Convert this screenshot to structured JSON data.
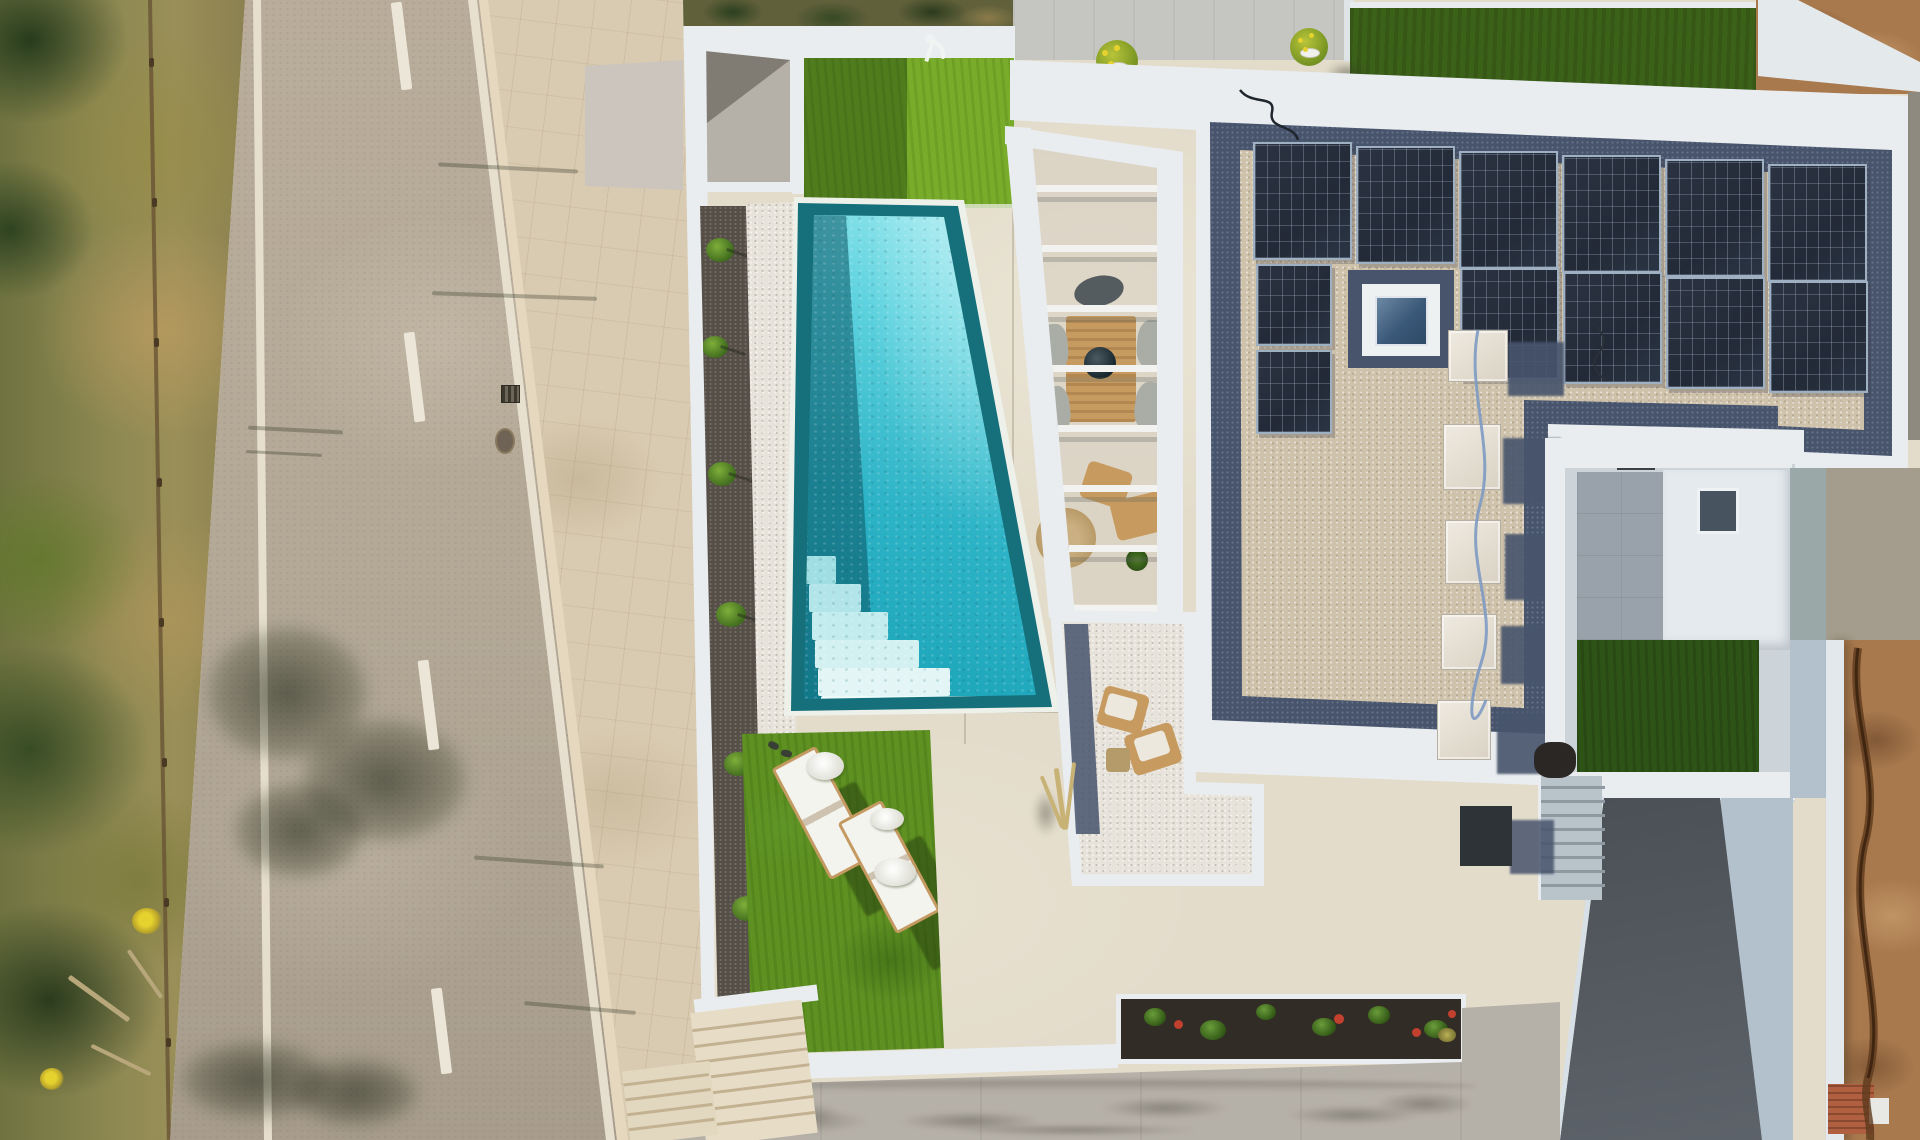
{
  "meta": {
    "description": "Top-down aerial drone photograph of a modern white villa with turquoise pool, solar-panel gravel roof, sun loungers on artificial lawn, pergola with outdoor furniture, street with scrub verge on the left and concrete driveway below."
  },
  "colors": {
    "wall": "#e9edf0",
    "terrace": "#e3dccb",
    "sidewalk": "#d9cbb1",
    "road": "#b3a896",
    "scrub": "#8d8852",
    "pool-border": "#16707c",
    "pool-water": "#2db3c6",
    "pool-water-light": "#a7ecf1",
    "pebble": "#e7e3da",
    "gravel": "#564f48",
    "grass": "#5f9122",
    "grass-dark": "#2e5316",
    "roof-gravel": "#cfc2ab",
    "roof-navy": "#47546c",
    "solar": "#232a37",
    "courtyard": "#99a2aa",
    "ramp": "#4a4f55",
    "apron": "#b3c1cd",
    "dirt": "#a9794e",
    "soil": "#322c26",
    "driveway": "#b6b1a8",
    "wood": "#c79b5f"
  },
  "counts": {
    "solar_panels": 12,
    "pergola_slats": 8,
    "sun_loungers": 2,
    "ac_units": 5,
    "pool_steps": 6,
    "road_dashes": 4,
    "potted_plants": 2
  },
  "sprites": {
    "street-sprites": [
      {
        "c": "dash",
        "n": "road-center-dash",
        "x": 396,
        "y": 2,
        "w": 11,
        "h": 88,
        "r": -7
      },
      {
        "c": "dash",
        "n": "road-center-dash",
        "x": 409,
        "y": 332,
        "w": 11,
        "h": 90,
        "r": -7
      },
      {
        "c": "dash",
        "n": "road-center-dash",
        "x": 423,
        "y": 660,
        "w": 11,
        "h": 90,
        "r": -7
      },
      {
        "c": "dash",
        "n": "road-center-dash",
        "x": 436,
        "y": 988,
        "w": 11,
        "h": 86,
        "r": -7
      },
      {
        "c": "streak",
        "n": "post-shadow",
        "x": 248,
        "y": 428,
        "w": 95,
        "h": 4,
        "r": 3
      },
      {
        "c": "streak",
        "n": "post-shadow",
        "x": 246,
        "y": 452,
        "w": 76,
        "h": 3,
        "r": 3
      },
      {
        "c": "streak",
        "n": "post-shadow",
        "x": 438,
        "y": 166,
        "w": 140,
        "h": 4,
        "r": 3
      },
      {
        "c": "streak",
        "n": "post-shadow",
        "x": 432,
        "y": 294,
        "w": 165,
        "h": 4,
        "r": 2
      },
      {
        "c": "streak",
        "n": "post-shadow",
        "x": 474,
        "y": 860,
        "w": 130,
        "h": 4,
        "r": 4
      },
      {
        "c": "streak",
        "n": "post-shadow",
        "x": 524,
        "y": 1006,
        "w": 112,
        "h": 4,
        "r": 5
      },
      {
        "c": "post",
        "n": "fence-post",
        "x": 149,
        "y": 58,
        "w": 5,
        "h": 9
      },
      {
        "c": "post",
        "n": "fence-post",
        "x": 152,
        "y": 198,
        "w": 5,
        "h": 9
      },
      {
        "c": "post",
        "n": "fence-post",
        "x": 154,
        "y": 338,
        "w": 5,
        "h": 9
      },
      {
        "c": "post",
        "n": "fence-post",
        "x": 157,
        "y": 478,
        "w": 5,
        "h": 9
      },
      {
        "c": "post",
        "n": "fence-post",
        "x": 159,
        "y": 618,
        "w": 5,
        "h": 9
      },
      {
        "c": "post",
        "n": "fence-post",
        "x": 162,
        "y": 758,
        "w": 5,
        "h": 9
      },
      {
        "c": "post",
        "n": "fence-post",
        "x": 164,
        "y": 898,
        "w": 5,
        "h": 9
      },
      {
        "c": "post",
        "n": "fence-post",
        "x": 166,
        "y": 1038,
        "w": 5,
        "h": 9
      },
      {
        "c": "log",
        "n": "fallen-log",
        "x": 62,
        "y": 996,
        "w": 74,
        "h": 5,
        "r": 36
      },
      {
        "c": "log",
        "n": "fallen-log",
        "x": 88,
        "y": 1058,
        "w": 66,
        "h": 4,
        "r": 26
      },
      {
        "c": "log",
        "n": "fallen-log",
        "x": 116,
        "y": 972,
        "w": 58,
        "h": 4,
        "r": 55
      },
      {
        "c": "flower",
        "n": "yellow-flower-bush",
        "x": 132,
        "y": 908,
        "w": 30,
        "h": 26
      },
      {
        "c": "flower",
        "n": "yellow-flower-bush",
        "x": 40,
        "y": 1068,
        "w": 24,
        "h": 22
      }
    ],
    "gravel-shrubs": [
      {
        "c": "shrub",
        "x": 8,
        "y": 32,
        "w": 28,
        "h": 24
      },
      {
        "c": "shrub",
        "x": 4,
        "y": 130,
        "w": 26,
        "h": 22
      },
      {
        "c": "shrub",
        "x": 10,
        "y": 256,
        "w": 28,
        "h": 24
      },
      {
        "c": "shrub",
        "x": 18,
        "y": 396,
        "w": 30,
        "h": 25
      },
      {
        "c": "shrub",
        "x": 26,
        "y": 546,
        "w": 28,
        "h": 24
      },
      {
        "c": "shrub",
        "x": 34,
        "y": 690,
        "w": 30,
        "h": 25
      }
    ],
    "pool-steps": [
      {
        "c": "pstep",
        "n": "pool-step",
        "x": 22,
        "y": 359,
        "w": 30,
        "h": 28,
        "bg": "#9fdfe3"
      },
      {
        "c": "pstep",
        "n": "pool-step",
        "x": 25,
        "y": 387,
        "w": 52,
        "h": 28,
        "bg": "#b2e5e9"
      },
      {
        "c": "pstep",
        "n": "pool-step",
        "x": 28,
        "y": 415,
        "w": 76,
        "h": 28,
        "bg": "#c3ecee"
      },
      {
        "c": "pstep",
        "n": "pool-step",
        "x": 31,
        "y": 443,
        "w": 104,
        "h": 28,
        "bg": "#d4f1f1"
      },
      {
        "c": "pstep",
        "n": "pool-step",
        "x": 34,
        "y": 471,
        "w": 132,
        "h": 28,
        "bg": "#e3f6f5"
      },
      {
        "c": "pstep",
        "n": "pool-step",
        "x": 37,
        "y": 499,
        "w": 160,
        "h": 28,
        "bg": "#ecfaf8"
      }
    ],
    "pergola-slats": [
      {
        "c": "slat",
        "x": 31,
        "y": 59,
        "w": 122,
        "h": 7
      },
      {
        "c": "slat",
        "x": 37,
        "y": 119,
        "w": 117,
        "h": 7
      },
      {
        "c": "slat",
        "x": 42,
        "y": 179,
        "w": 112,
        "h": 7
      },
      {
        "c": "slat",
        "x": 47,
        "y": 239,
        "w": 107,
        "h": 7
      },
      {
        "c": "slat",
        "x": 53,
        "y": 299,
        "w": 101,
        "h": 7
      },
      {
        "c": "slat",
        "x": 58,
        "y": 359,
        "w": 96,
        "h": 7
      },
      {
        "c": "slat",
        "x": 64,
        "y": 419,
        "w": 90,
        "h": 7
      },
      {
        "c": "slat",
        "x": 69,
        "y": 479,
        "w": 85,
        "h": 7
      }
    ],
    "pergola-furniture": [
      {
        "c": "wood",
        "n": "dining-table",
        "x": 61,
        "y": 190,
        "w": 70,
        "h": 106
      },
      {
        "c": "bowl",
        "n": "table-bowl",
        "x": 79,
        "y": 221,
        "w": 32,
        "h": 32
      },
      {
        "c": "chairgray",
        "n": "chair",
        "x": 36,
        "y": 198,
        "w": 27,
        "h": 46,
        "r": -4
      },
      {
        "c": "chairgray",
        "n": "chair",
        "x": 132,
        "y": 194,
        "w": 31,
        "h": 48,
        "r": 5
      },
      {
        "c": "chairgray",
        "n": "chair",
        "x": 38,
        "y": 260,
        "w": 27,
        "h": 46,
        "r": -6
      },
      {
        "c": "chairgray",
        "n": "chair",
        "x": 130,
        "y": 256,
        "w": 31,
        "h": 48,
        "r": 7
      },
      {
        "c": "darkarc",
        "n": "rattan-chair",
        "x": 69,
        "y": 150,
        "w": 50,
        "h": 30,
        "r": -12
      },
      {
        "c": "woodchair",
        "n": "wood-armchair",
        "x": 78,
        "y": 340,
        "w": 46,
        "h": 38,
        "r": 18
      },
      {
        "c": "woodchair",
        "n": "wood-armchair",
        "x": 108,
        "y": 370,
        "w": 52,
        "h": 40,
        "r": -14
      },
      {
        "c": "mat",
        "n": "round-jute-mat",
        "x": 31,
        "y": 382,
        "w": 60,
        "h": 60
      },
      {
        "c": "plantpot",
        "n": "potted-plant",
        "x": 121,
        "y": 423,
        "w": 22,
        "h": 22
      }
    ],
    "court-items": [
      {
        "c": "woodchair",
        "n": "lounge-chair",
        "x": 52,
        "y": 82,
        "w": 46,
        "h": 40,
        "r": 15
      },
      {
        "c": "woodchair",
        "n": "lounge-chair",
        "x": 80,
        "y": 120,
        "w": 50,
        "h": 42,
        "r": -18
      },
      {
        "c": "cushion",
        "n": "cushion",
        "x": 58,
        "y": 88,
        "w": 30,
        "h": 22,
        "r": 15
      },
      {
        "c": "cushion",
        "n": "cushion",
        "x": 88,
        "y": 126,
        "w": 32,
        "h": 24,
        "r": -18
      },
      {
        "c": "ctable",
        "n": "side-table",
        "x": 58,
        "y": 140,
        "w": 24,
        "h": 24
      }
    ],
    "roof-panels": [
      {
        "c": "panel",
        "n": "solar-panel",
        "x": 243,
        "y": 82,
        "w": 99,
        "h": 118
      },
      {
        "c": "panel",
        "n": "solar-panel",
        "x": 346,
        "y": 86,
        "w": 99,
        "h": 118
      },
      {
        "c": "panel",
        "n": "solar-panel",
        "x": 449,
        "y": 91,
        "w": 99,
        "h": 118
      },
      {
        "c": "panel",
        "n": "solar-panel",
        "x": 552,
        "y": 95,
        "w": 99,
        "h": 118
      },
      {
        "c": "panel",
        "n": "solar-panel",
        "x": 655,
        "y": 99,
        "w": 99,
        "h": 118
      },
      {
        "c": "panel",
        "n": "solar-panel",
        "x": 758,
        "y": 104,
        "w": 99,
        "h": 118
      },
      {
        "c": "panel",
        "n": "solar-panel",
        "x": 450,
        "y": 208,
        "w": 99,
        "h": 112
      },
      {
        "c": "panel",
        "n": "solar-panel",
        "x": 553,
        "y": 212,
        "w": 99,
        "h": 112
      },
      {
        "c": "panel",
        "n": "solar-panel",
        "x": 656,
        "y": 217,
        "w": 99,
        "h": 112
      },
      {
        "c": "panel",
        "n": "solar-panel",
        "x": 759,
        "y": 221,
        "w": 99,
        "h": 112
      },
      {
        "c": "panel",
        "n": "solar-panel",
        "x": 246,
        "y": 204,
        "w": 76,
        "h": 82
      },
      {
        "c": "panel",
        "n": "solar-panel",
        "x": 246,
        "y": 290,
        "w": 76,
        "h": 84
      }
    ],
    "roof-ac": [
      {
        "c": "acshadow",
        "n": "ac-shadow",
        "x": 498,
        "y": 282,
        "w": 56,
        "h": 54
      },
      {
        "c": "acshadow",
        "n": "ac-shadow",
        "x": 493,
        "y": 378,
        "w": 58,
        "h": 66
      },
      {
        "c": "acshadow",
        "n": "ac-shadow",
        "x": 495,
        "y": 474,
        "w": 56,
        "h": 66
      },
      {
        "c": "acshadow",
        "n": "ac-shadow",
        "x": 491,
        "y": 566,
        "w": 56,
        "h": 58
      },
      {
        "c": "acshadow",
        "n": "ac-shadow",
        "x": 487,
        "y": 652,
        "w": 54,
        "h": 62
      },
      {
        "c": "acunit",
        "n": "ac-unit",
        "x": 438,
        "y": 270,
        "w": 60,
        "h": 52
      },
      {
        "c": "acunit",
        "n": "ac-unit",
        "x": 433,
        "y": 364,
        "w": 58,
        "h": 66
      },
      {
        "c": "acunit",
        "n": "ac-unit",
        "x": 435,
        "y": 460,
        "w": 56,
        "h": 64
      },
      {
        "c": "acunit",
        "n": "ac-unit",
        "x": 431,
        "y": 554,
        "w": 56,
        "h": 56
      },
      {
        "c": "acunit",
        "n": "ac-unit",
        "x": 427,
        "y": 640,
        "w": 54,
        "h": 60
      }
    ],
    "cstairs-treads": [
      {
        "c": "tread",
        "x": 0,
        "y": 10,
        "w": 64,
        "h": 3
      },
      {
        "c": "tread",
        "x": 0,
        "y": 24,
        "w": 64,
        "h": 3
      },
      {
        "c": "tread",
        "x": 0,
        "y": 38,
        "w": 64,
        "h": 3
      },
      {
        "c": "tread",
        "x": 0,
        "y": 52,
        "w": 64,
        "h": 3
      },
      {
        "c": "tread",
        "x": 0,
        "y": 66,
        "w": 64,
        "h": 3
      },
      {
        "c": "tread",
        "x": 0,
        "y": 80,
        "w": 64,
        "h": 3
      },
      {
        "c": "tread",
        "x": 0,
        "y": 94,
        "w": 64,
        "h": 3
      },
      {
        "c": "tread",
        "x": 0,
        "y": 108,
        "w": 64,
        "h": 3
      }
    ],
    "sw1-treads": [
      {
        "c": "tread2",
        "x": 0,
        "y": 16,
        "w": 112,
        "h": 3
      },
      {
        "c": "tread2",
        "x": 0,
        "y": 32,
        "w": 112,
        "h": 3
      },
      {
        "c": "tread2",
        "x": 0,
        "y": 48,
        "w": 112,
        "h": 3
      },
      {
        "c": "tread2",
        "x": 0,
        "y": 64,
        "w": 112,
        "h": 3
      },
      {
        "c": "tread2",
        "x": 0,
        "y": 80,
        "w": 112,
        "h": 3
      },
      {
        "c": "tread2",
        "x": 0,
        "y": 96,
        "w": 112,
        "h": 3
      },
      {
        "c": "tread2",
        "x": 0,
        "y": 112,
        "w": 112,
        "h": 3
      }
    ],
    "sw2-treads": [
      {
        "c": "tread2",
        "x": 0,
        "y": 12,
        "w": 86,
        "h": 3
      },
      {
        "c": "tread2",
        "x": 0,
        "y": 27,
        "w": 86,
        "h": 3
      },
      {
        "c": "tread2",
        "x": 0,
        "y": 42,
        "w": 86,
        "h": 3
      },
      {
        "c": "tread2",
        "x": 0,
        "y": 57,
        "w": 86,
        "h": 3
      }
    ],
    "planter-plants": [
      {
        "c": "pgreen",
        "n": "planter-shrub",
        "x": 28,
        "y": 14,
        "w": 22,
        "h": 18
      },
      {
        "c": "pgreen",
        "n": "planter-shrub",
        "x": 84,
        "y": 26,
        "w": 26,
        "h": 20
      },
      {
        "c": "pgreen",
        "n": "planter-shrub",
        "x": 140,
        "y": 10,
        "w": 20,
        "h": 16
      },
      {
        "c": "pgreen",
        "n": "planter-shrub",
        "x": 196,
        "y": 24,
        "w": 24,
        "h": 18
      },
      {
        "c": "pgreen",
        "n": "planter-shrub",
        "x": 252,
        "y": 12,
        "w": 22,
        "h": 18
      },
      {
        "c": "pgreen",
        "n": "planter-shrub",
        "x": 308,
        "y": 26,
        "w": 24,
        "h": 18
      },
      {
        "c": "pred",
        "n": "red-flower",
        "x": 58,
        "y": 26,
        "w": 9,
        "h": 9
      },
      {
        "c": "pred",
        "n": "red-flower",
        "x": 218,
        "y": 20,
        "w": 10,
        "h": 10
      },
      {
        "c": "pred",
        "n": "red-flower",
        "x": 296,
        "y": 34,
        "w": 9,
        "h": 9
      },
      {
        "c": "pred",
        "n": "red-flower",
        "x": 332,
        "y": 16,
        "w": 8,
        "h": 8
      },
      {
        "c": "pdry",
        "n": "dry-plant",
        "x": 322,
        "y": 34,
        "w": 18,
        "h": 14
      }
    ],
    "grass-items": [
      {
        "c": "lshadow",
        "n": "lounger-shadow",
        "x": 92,
        "y": 58,
        "w": 54,
        "h": 126,
        "r": -28
      },
      {
        "c": "lshadow",
        "n": "lounger-shadow",
        "x": 158,
        "y": 112,
        "w": 54,
        "h": 126,
        "r": -28
      },
      {
        "c": "lounger",
        "n": "sun-lounger",
        "x": 56,
        "y": 22,
        "w": 50,
        "h": 126,
        "r": -28
      },
      {
        "c": "lounger",
        "n": "sun-lounger",
        "x": 122,
        "y": 76,
        "w": 50,
        "h": 126,
        "r": -28
      },
      {
        "c": "towel",
        "n": "towel",
        "x": 64,
        "y": 24,
        "w": 38,
        "h": 28
      },
      {
        "c": "towel",
        "n": "towel",
        "x": 128,
        "y": 80,
        "w": 34,
        "h": 22
      },
      {
        "c": "towel",
        "n": "towel",
        "x": 132,
        "y": 130,
        "w": 42,
        "h": 28
      },
      {
        "c": "slipper",
        "n": "slipper",
        "x": 26,
        "y": 14,
        "w": 11,
        "h": 7,
        "r": 25
      },
      {
        "c": "slipper",
        "n": "slipper",
        "x": 39,
        "y": 22,
        "w": 11,
        "h": 7,
        "r": 15
      }
    ],
    "drive-stains": [
      {
        "c": "stain",
        "x": 50,
        "y": 96,
        "w": 150,
        "h": 34
      },
      {
        "c": "stain",
        "x": 215,
        "y": 108,
        "w": 190,
        "h": 26
      },
      {
        "c": "stain",
        "x": 420,
        "y": 94,
        "w": 170,
        "h": 28
      },
      {
        "c": "stain",
        "x": 605,
        "y": 102,
        "w": 175,
        "h": 26
      },
      {
        "c": "stain",
        "x": 250,
        "y": 122,
        "w": 330,
        "h": 16
      },
      {
        "c": "stain",
        "x": 700,
        "y": 88,
        "w": 130,
        "h": 32
      },
      {
        "c": "stain",
        "x": 25,
        "y": 104,
        "w": 210,
        "h": 34
      },
      {
        "c": "stain",
        "n": "wall-shadow",
        "x": 36,
        "y": 80,
        "w": 780,
        "h": 12,
        "bg": "linear-gradient(rgba(60,55,48,.3),transparent)"
      }
    ],
    "pot-dots": [
      {
        "c": "dot",
        "n": "yellow-bloom",
        "x": 1102,
        "y": 50,
        "w": 6,
        "h": 6
      },
      {
        "c": "dot",
        "n": "yellow-bloom",
        "x": 1114,
        "y": 45,
        "w": 6,
        "h": 6
      },
      {
        "c": "dot",
        "n": "yellow-bloom",
        "x": 1108,
        "y": 61,
        "w": 6,
        "h": 6
      },
      {
        "c": "dot",
        "n": "yellow-bloom",
        "x": 1298,
        "y": 38,
        "w": 5,
        "h": 5
      },
      {
        "c": "dot",
        "n": "yellow-bloom",
        "x": 1309,
        "y": 33,
        "w": 5,
        "h": 5
      },
      {
        "c": "dot",
        "n": "yellow-bloom",
        "x": 1303,
        "y": 47,
        "w": 5,
        "h": 5
      }
    ]
  }
}
